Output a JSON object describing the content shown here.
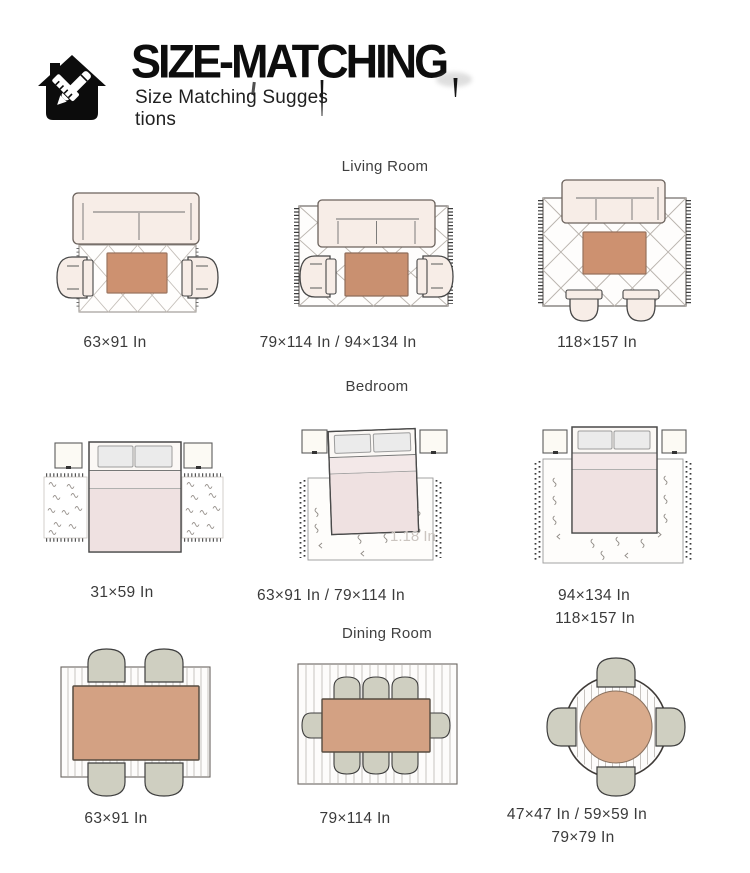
{
  "header": {
    "title": "SIZE-MATCHING",
    "subtitle_line1": "Size Matching Sugges",
    "subtitle_line2": "tions"
  },
  "sections": {
    "living_room": {
      "title": "Living Room",
      "sizes": [
        "63×91 In",
        "79×114 In / 94×134 In",
        "118×157 In"
      ]
    },
    "bedroom": {
      "title": "Bedroom",
      "sizes": [
        "31×59 In",
        "63×91 In / 79×114 In",
        "94×134 In",
        "118×157 In"
      ],
      "watermark": "1.18 In"
    },
    "dining_room": {
      "title": "Dining Room",
      "sizes": [
        "63×91 In",
        "79×114 In",
        "47×47 In / 59×59 In",
        "79×79 In"
      ]
    }
  },
  "colors": {
    "ink": "#0d0d0d",
    "label_gray": "#3a3a3a",
    "sofa_cream": "#f7ede7",
    "blanket_pink": "#efe1e1",
    "coffee_table_terracotta": "#cd9170",
    "dining_table_tan": "#d3a183",
    "chair_sage": "#cfcfc1"
  }
}
